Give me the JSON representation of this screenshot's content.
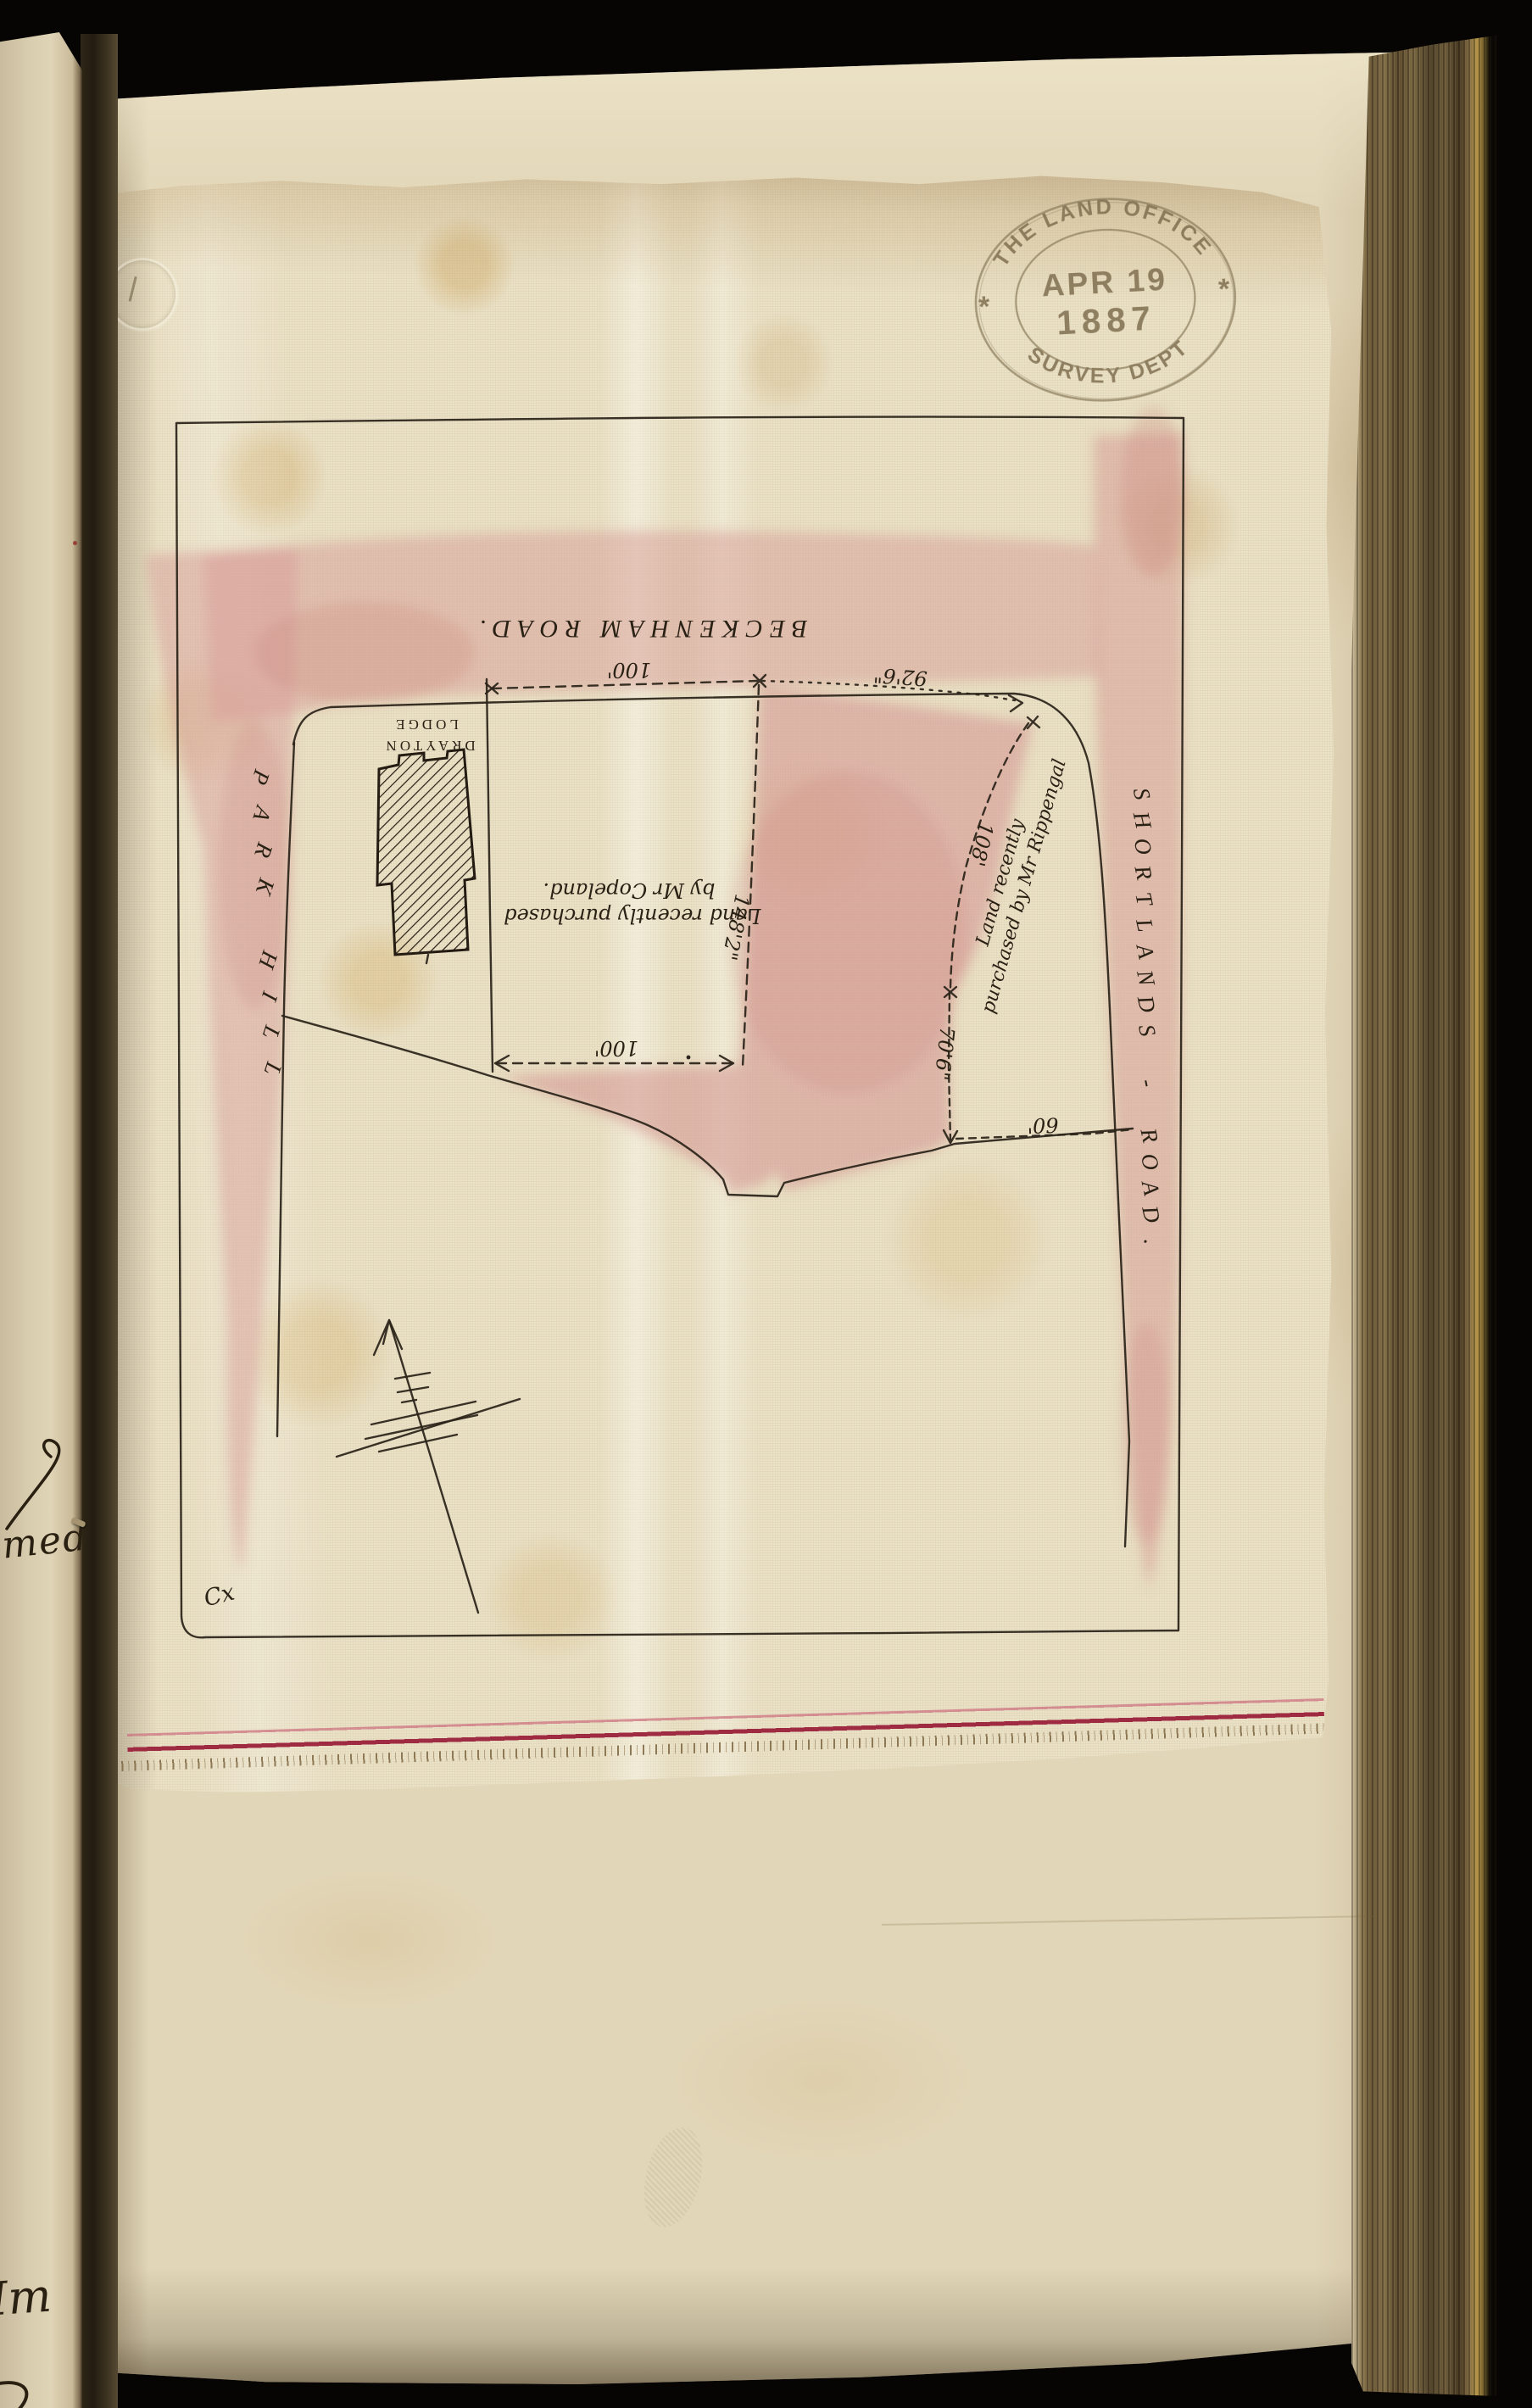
{
  "stamp": {
    "arc_top": "THE LAND OFFICE",
    "arc_bottom": "SURVEY DEPT",
    "star_left": "*",
    "star_right": "*",
    "date_line1": "APR 19",
    "date_line2": "1887"
  },
  "map": {
    "roads": {
      "top": "BECKENHAM ROAD.",
      "left": "PARK HILL",
      "right": "SHORTLANDS - ROAD."
    },
    "building": {
      "line1": "DRAYTON",
      "line2": "LODGE"
    },
    "annotations": {
      "copeland_line1": "Land recently purchased",
      "copeland_line2": "by Mr Copeland.",
      "rippengal_line1": "Land recently",
      "rippengal_line2": "purchased by Mr Rippengal"
    },
    "dimensions": {
      "top_left": "100'",
      "top_right": "92'6\"",
      "middle_vertical": "148'2\"",
      "bottom": "100'",
      "side": "70'6\"",
      "bottom_right": "60'",
      "diagonal": "108'"
    },
    "corner_mark": "Cx"
  },
  "facing_page": {
    "fragment1": "amed",
    "fragment2": "Im"
  },
  "colors": {
    "wash_pink": "#d79e98",
    "ink": "#2d251b",
    "stamp_ink": "#7c6b4c",
    "selvage_red": "#9e2b42"
  }
}
